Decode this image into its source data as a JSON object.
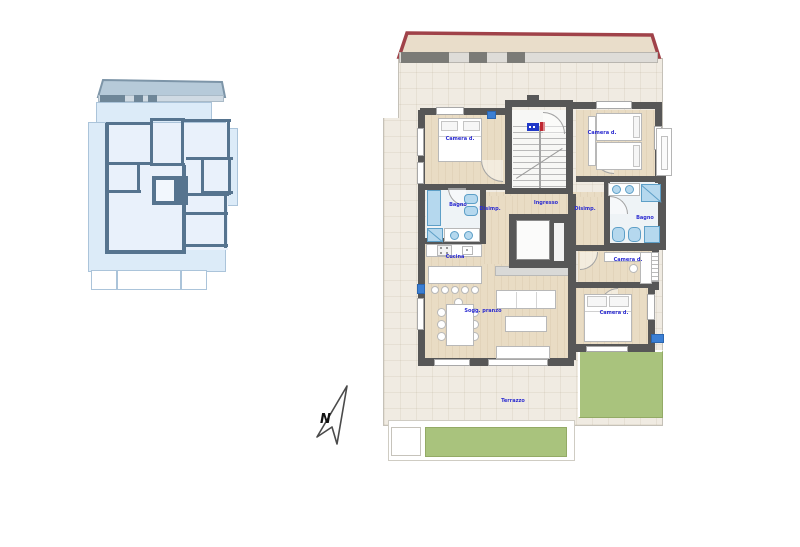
{
  "title": "Apartment floor plan drawing with key plan and north arrow",
  "key_plan": {
    "description": "small blue key plan of the same floor",
    "fill": "#dcebf8",
    "wall_color": "#56748f"
  },
  "main_plan": {
    "labels": {
      "camera_tl": "Camera d.",
      "camera_tr": "Camera d.",
      "camera_mid": "Camera d.",
      "camera_br": "Camera d.",
      "bagno_left": "Bagno",
      "bagno_right": "Bagno",
      "cucina": "Cucina",
      "soggiorno": "Sogg. pranzo",
      "disimpegno_left": "Disimp.",
      "ingresso": "Ingresso",
      "disimpegno_right": "Disimp.",
      "terrazzo": "Terrazzo"
    }
  },
  "compass": {
    "north_label": "N"
  },
  "colors": {
    "wall": "#575757",
    "wood_floor": "#e9dcc4",
    "terrace": "#f0ebe2",
    "bath_floor": "#eef3f6",
    "fixture_blue": "#b5d8ee",
    "fixture_border": "#5d9fc7",
    "roof_edge": "#a04249",
    "roof_fill": "#e9ddca",
    "green_area": "#a9c37d",
    "label_blue": "#2b2bd0",
    "key_plan_fill": "#dcebf8",
    "key_plan_wall": "#56748f"
  }
}
